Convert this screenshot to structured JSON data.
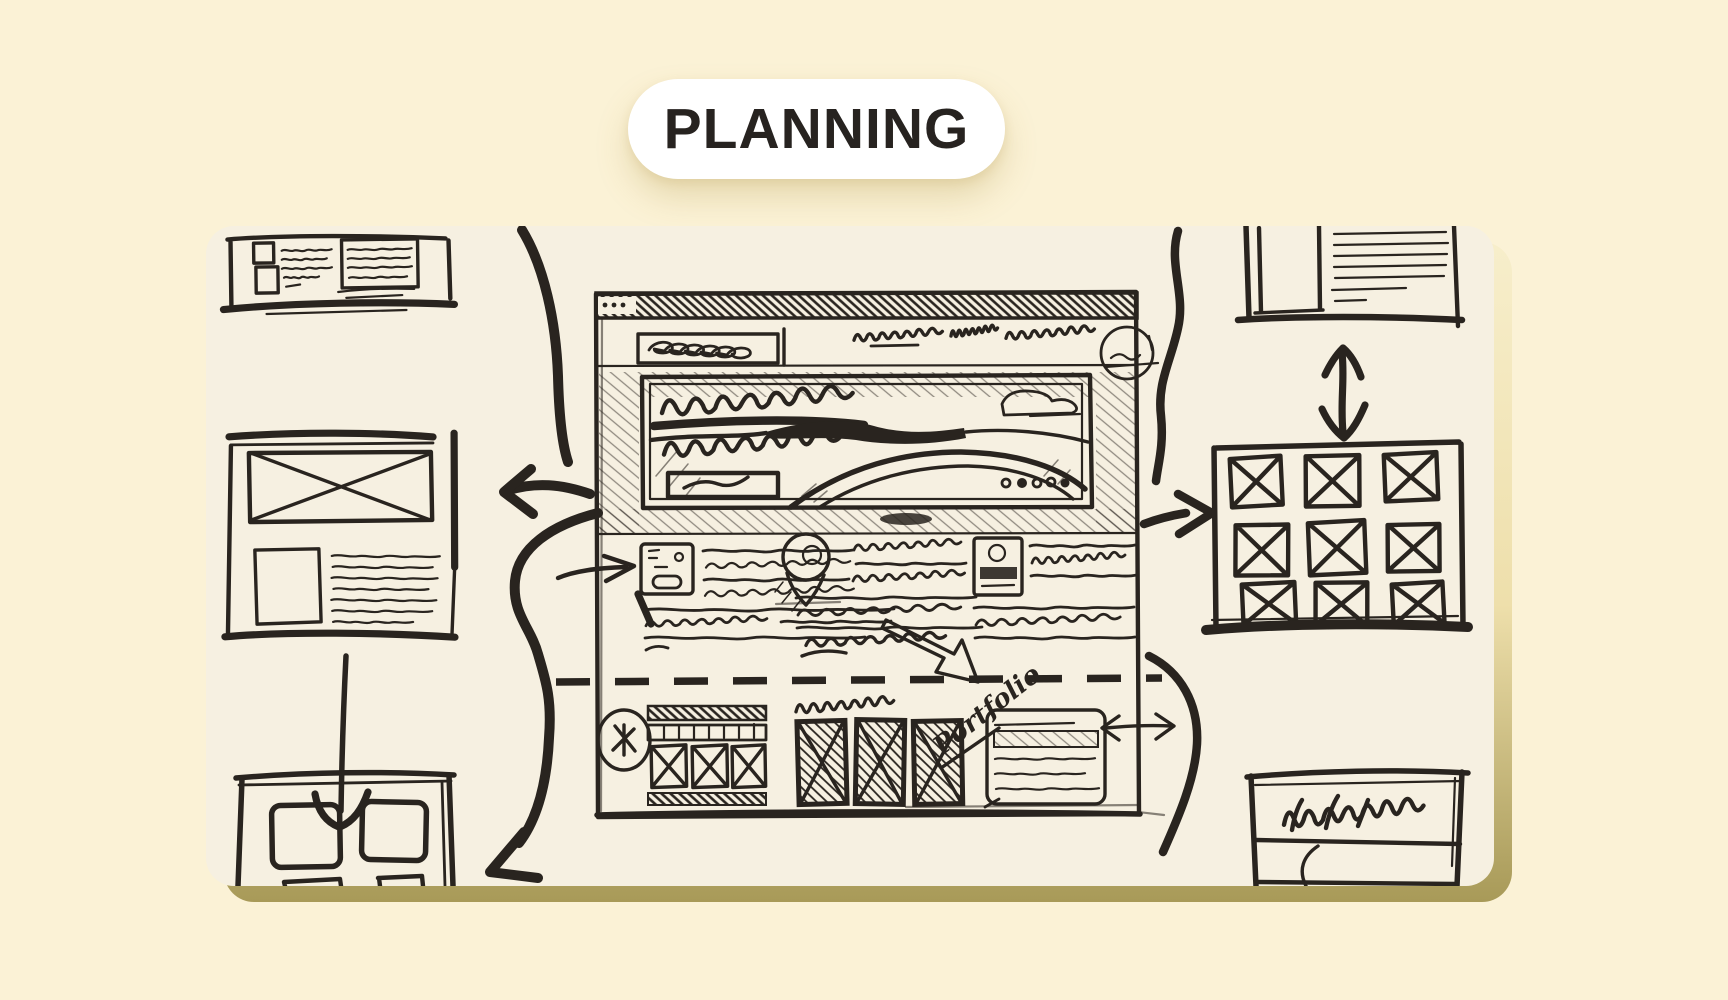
{
  "page": {
    "background": "#fbf2d6"
  },
  "badge": {
    "label": "PLANNING"
  },
  "sketch": {
    "paper_color": "#f6f0e1",
    "ink_color": "#29241f",
    "shadow_color": "#a89a58",
    "handwritten_label": "Portfolio"
  }
}
